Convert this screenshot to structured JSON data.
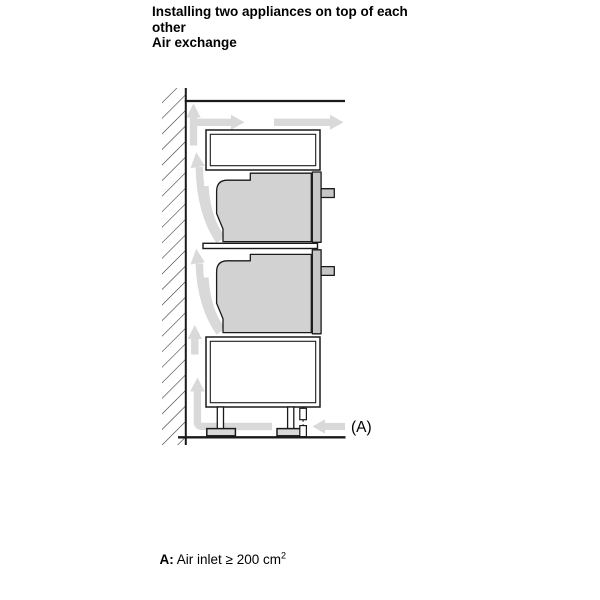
{
  "title": {
    "line1": "Installing two appliances on top of each",
    "line2": "other",
    "line3": "Air exchange"
  },
  "diagram": {
    "label_a": "(A)"
  },
  "footnote": {
    "term": "A:",
    "text": " Air inlet ≥ 200 cm",
    "superscript": "2"
  },
  "colors": {
    "outline": "#1a1a1a",
    "appliance_body": "#d2d2d2",
    "appliance_front": "#c6c6c6",
    "airflow_arrow": "#d9d9d9",
    "foot": "#d9d9d9",
    "background": "#ffffff"
  }
}
